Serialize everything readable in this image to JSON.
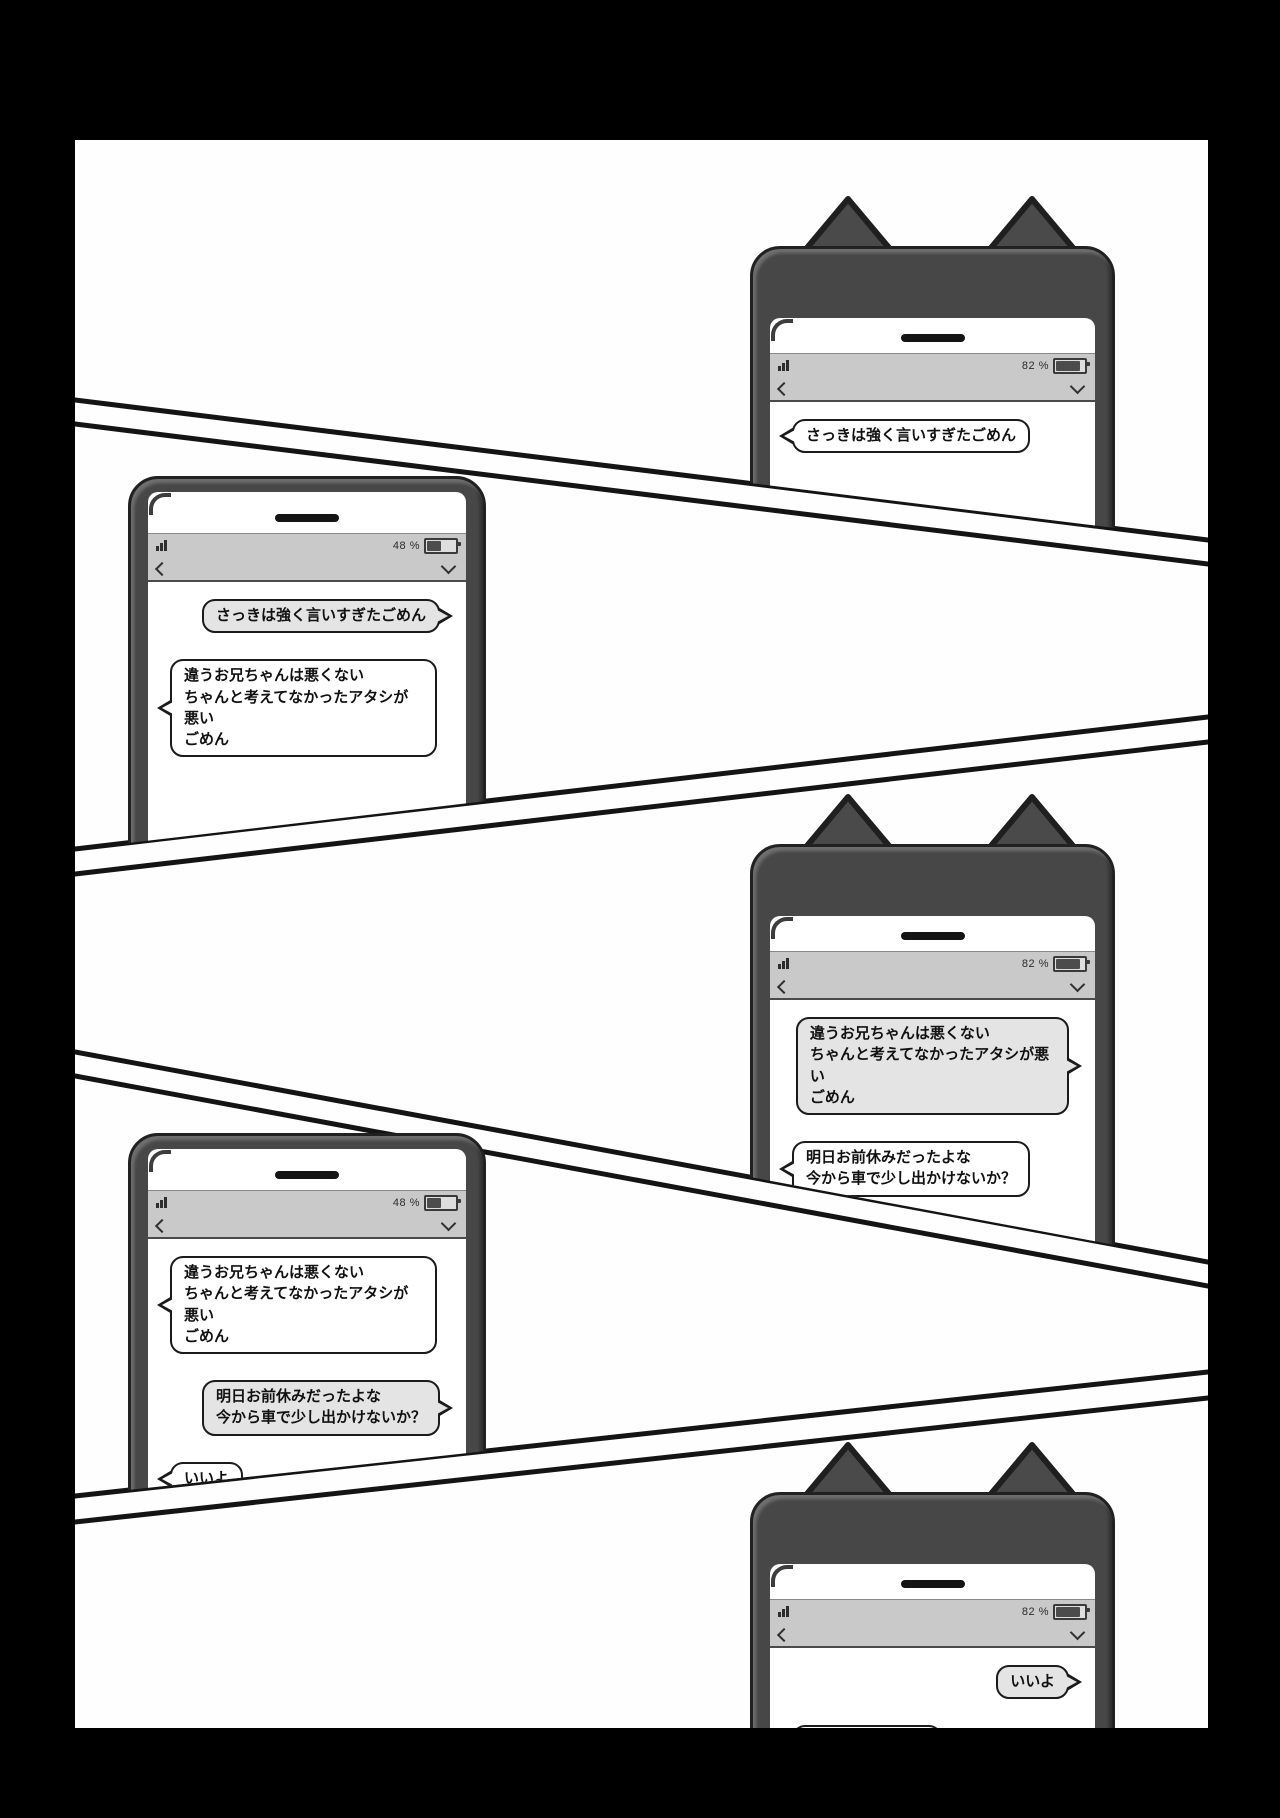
{
  "page": {
    "type": "manga-page",
    "background_color": "#000000",
    "paper_color": "#fefefe",
    "panel_line_color": "#141414"
  },
  "colors": {
    "phone_frame": "#474747",
    "status_bar": "#c9c9c9",
    "bubble_sent_fill": "#e4e4e4",
    "bubble_received_fill": "#ffffff",
    "bubble_border": "#1b1b1b"
  },
  "phones": [
    {
      "variant": "cat-ears",
      "status": {
        "signal_icon": "signal-bars-icon",
        "battery_label": "82 %",
        "battery_percent": 82,
        "back_icon": "chevron-left-icon",
        "collapse_icon": "chevron-down-icon"
      },
      "messages": [
        {
          "direction": "received",
          "text": "さっきは強く言いすぎたごめん"
        }
      ]
    },
    {
      "variant": "plain",
      "status": {
        "signal_icon": "signal-bars-icon",
        "battery_label": "48 %",
        "battery_percent": 48,
        "back_icon": "chevron-left-icon",
        "collapse_icon": "chevron-down-icon"
      },
      "messages": [
        {
          "direction": "sent",
          "text": "さっきは強く言いすぎたごめん"
        },
        {
          "direction": "received",
          "text": "違うお兄ちゃんは悪くない\nちゃんと考えてなかったアタシが悪い\nごめん"
        }
      ]
    },
    {
      "variant": "cat-ears",
      "status": {
        "signal_icon": "signal-bars-icon",
        "battery_label": "82 %",
        "battery_percent": 82,
        "back_icon": "chevron-left-icon",
        "collapse_icon": "chevron-down-icon"
      },
      "messages": [
        {
          "direction": "sent",
          "text": "違うお兄ちゃんは悪くない\nちゃんと考えてなかったアタシが悪い\nごめん"
        },
        {
          "direction": "received",
          "text": "明日お前休みだったよな\n今から車で少し出かけないか？"
        }
      ]
    },
    {
      "variant": "plain",
      "status": {
        "signal_icon": "signal-bars-icon",
        "battery_label": "48 %",
        "battery_percent": 48,
        "back_icon": "chevron-left-icon",
        "collapse_icon": "chevron-down-icon"
      },
      "messages": [
        {
          "direction": "received",
          "text": "違うお兄ちゃんは悪くない\nちゃんと考えてなかったアタシが悪い\nごめん"
        },
        {
          "direction": "sent",
          "text": "明日お前休みだったよな\n今から車で少し出かけないか？"
        },
        {
          "direction": "received",
          "text": "いいよ"
        }
      ]
    },
    {
      "variant": "cat-ears",
      "status": {
        "signal_icon": "signal-bars-icon",
        "battery_label": "82 %",
        "battery_percent": 82,
        "back_icon": "chevron-left-icon",
        "collapse_icon": "chevron-down-icon"
      },
      "messages": [
        {
          "direction": "sent",
          "text": "いいよ"
        },
        {
          "direction": "received",
          "text": "22時に迎えに行く"
        }
      ]
    }
  ]
}
